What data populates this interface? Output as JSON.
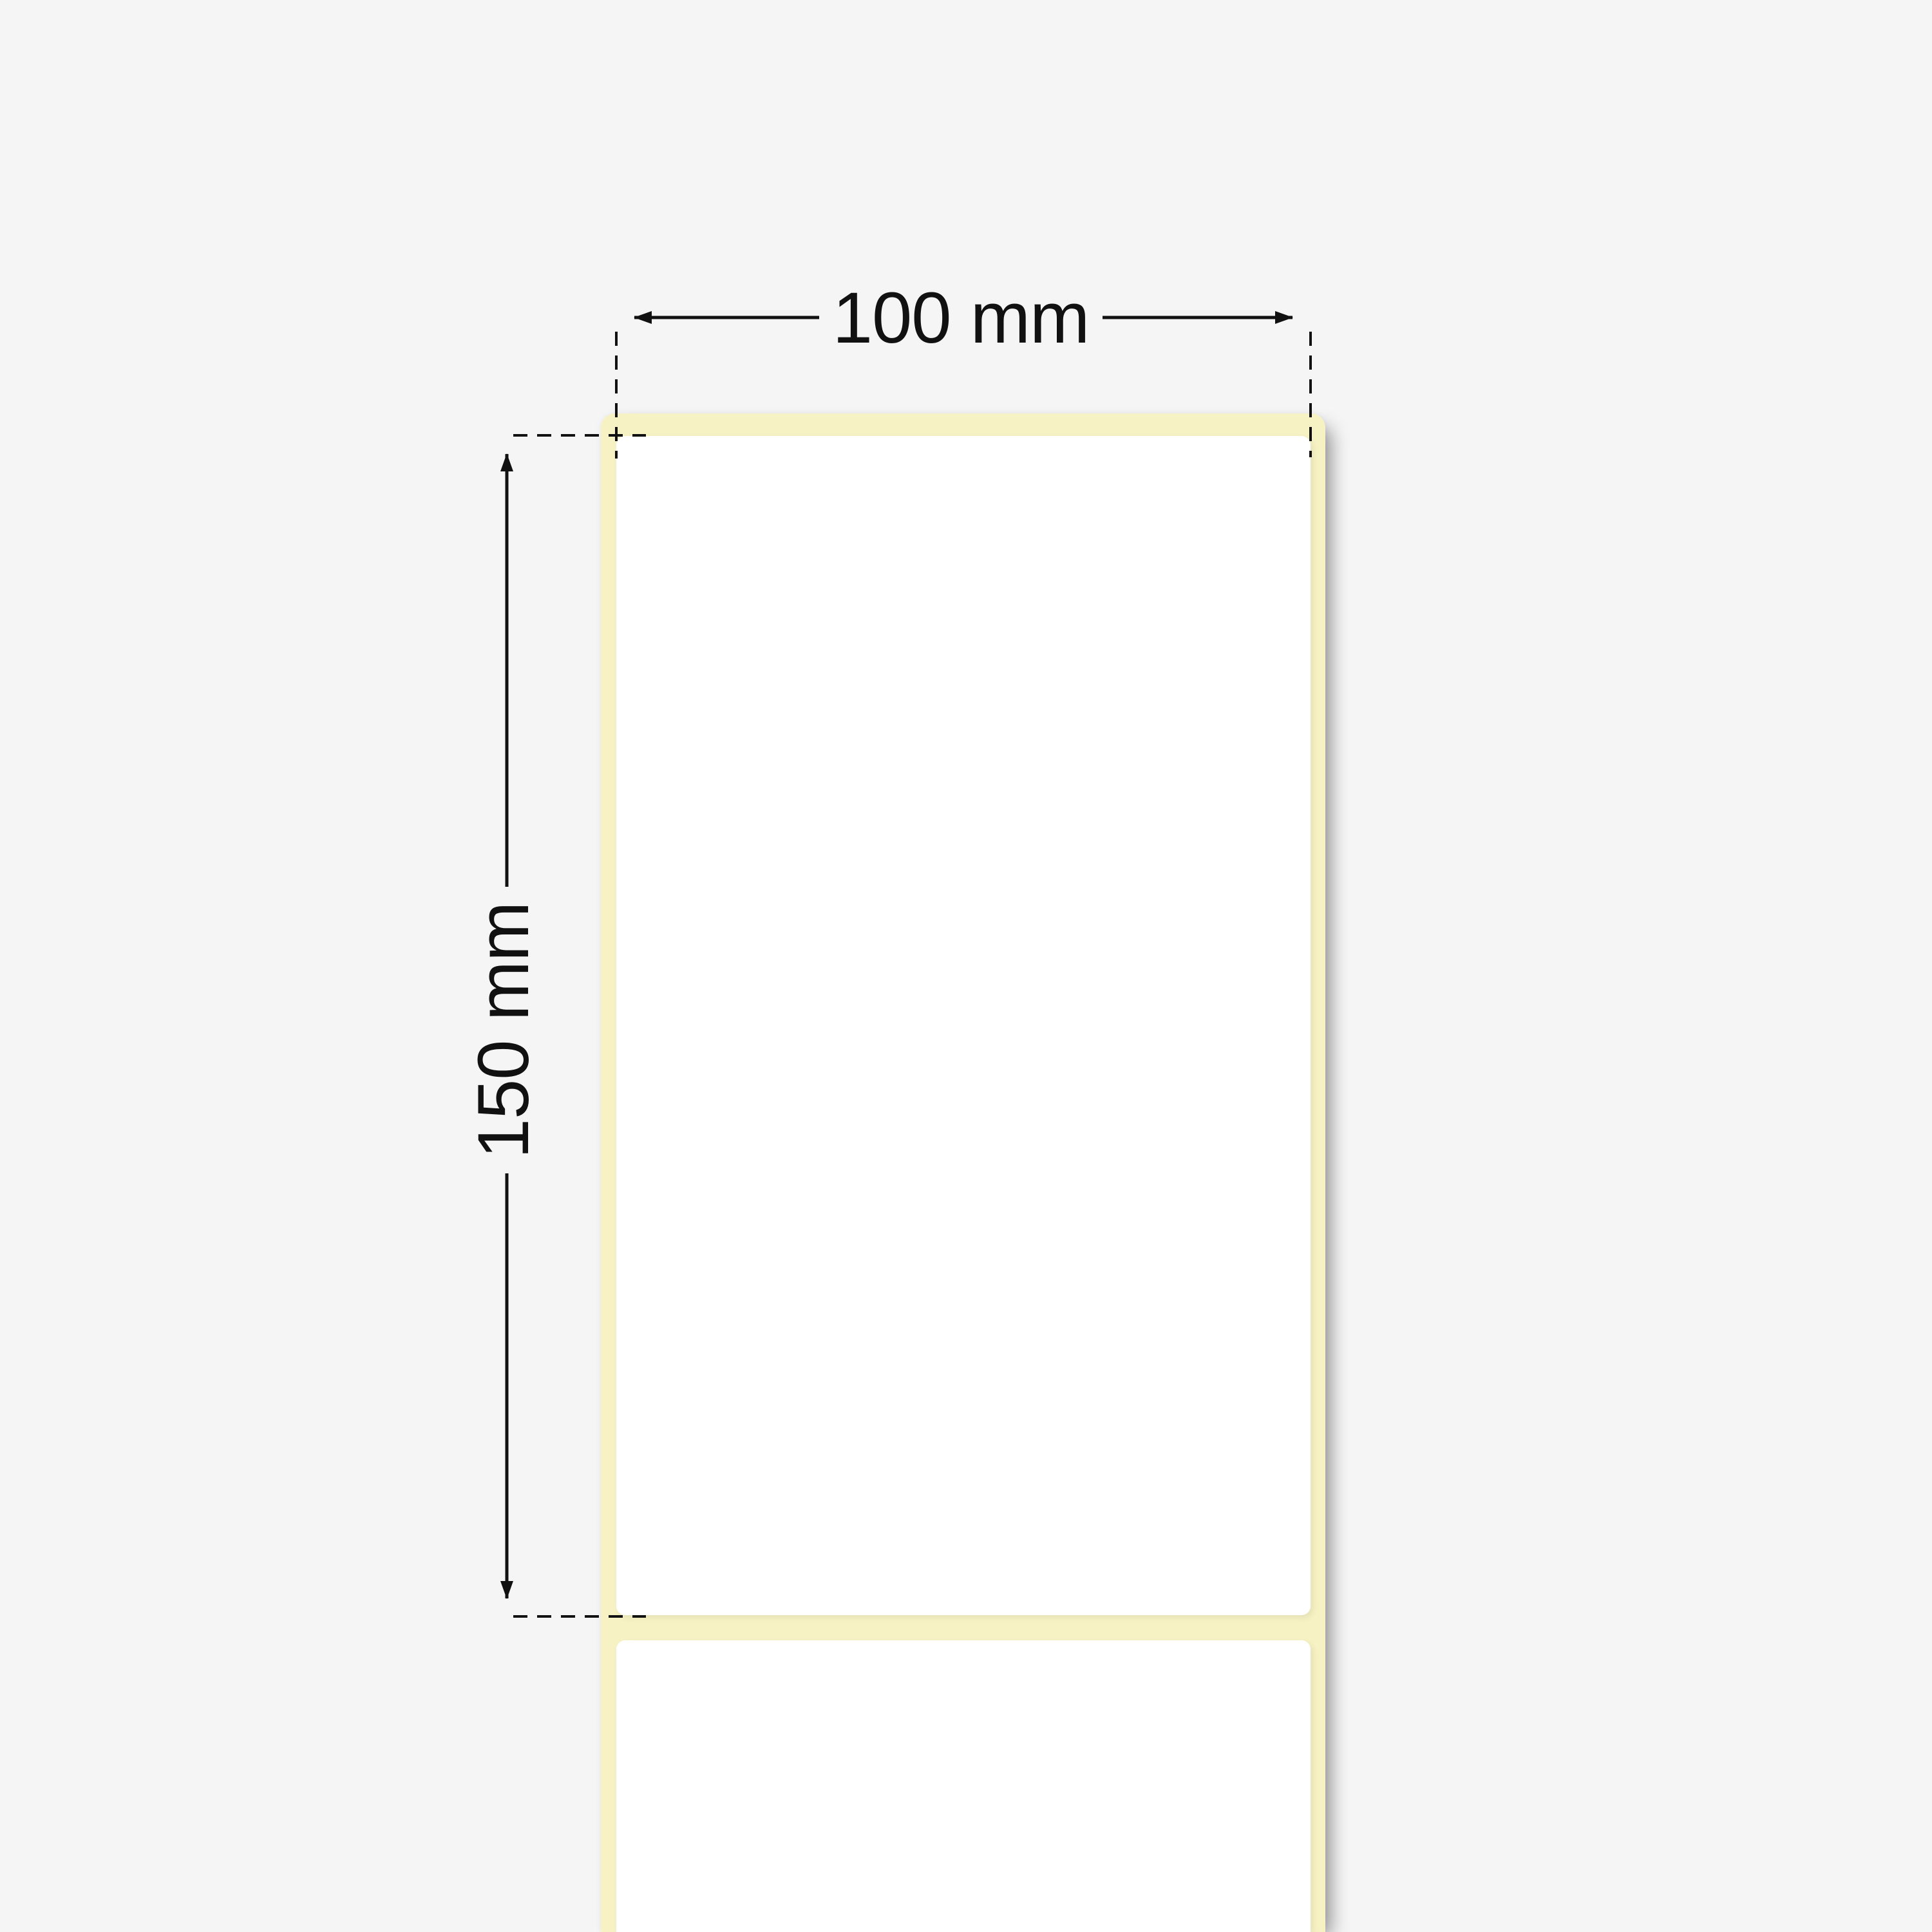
{
  "diagram": {
    "subject": "thermal-label-roll-with-liner",
    "width_dimension": {
      "label": "100 mm"
    },
    "height_dimension": {
      "label": "150 mm"
    },
    "colors": {
      "background": "#f5f5f6",
      "liner": "#f6f2c4",
      "label": "#ffffff",
      "line": "#111111"
    }
  }
}
